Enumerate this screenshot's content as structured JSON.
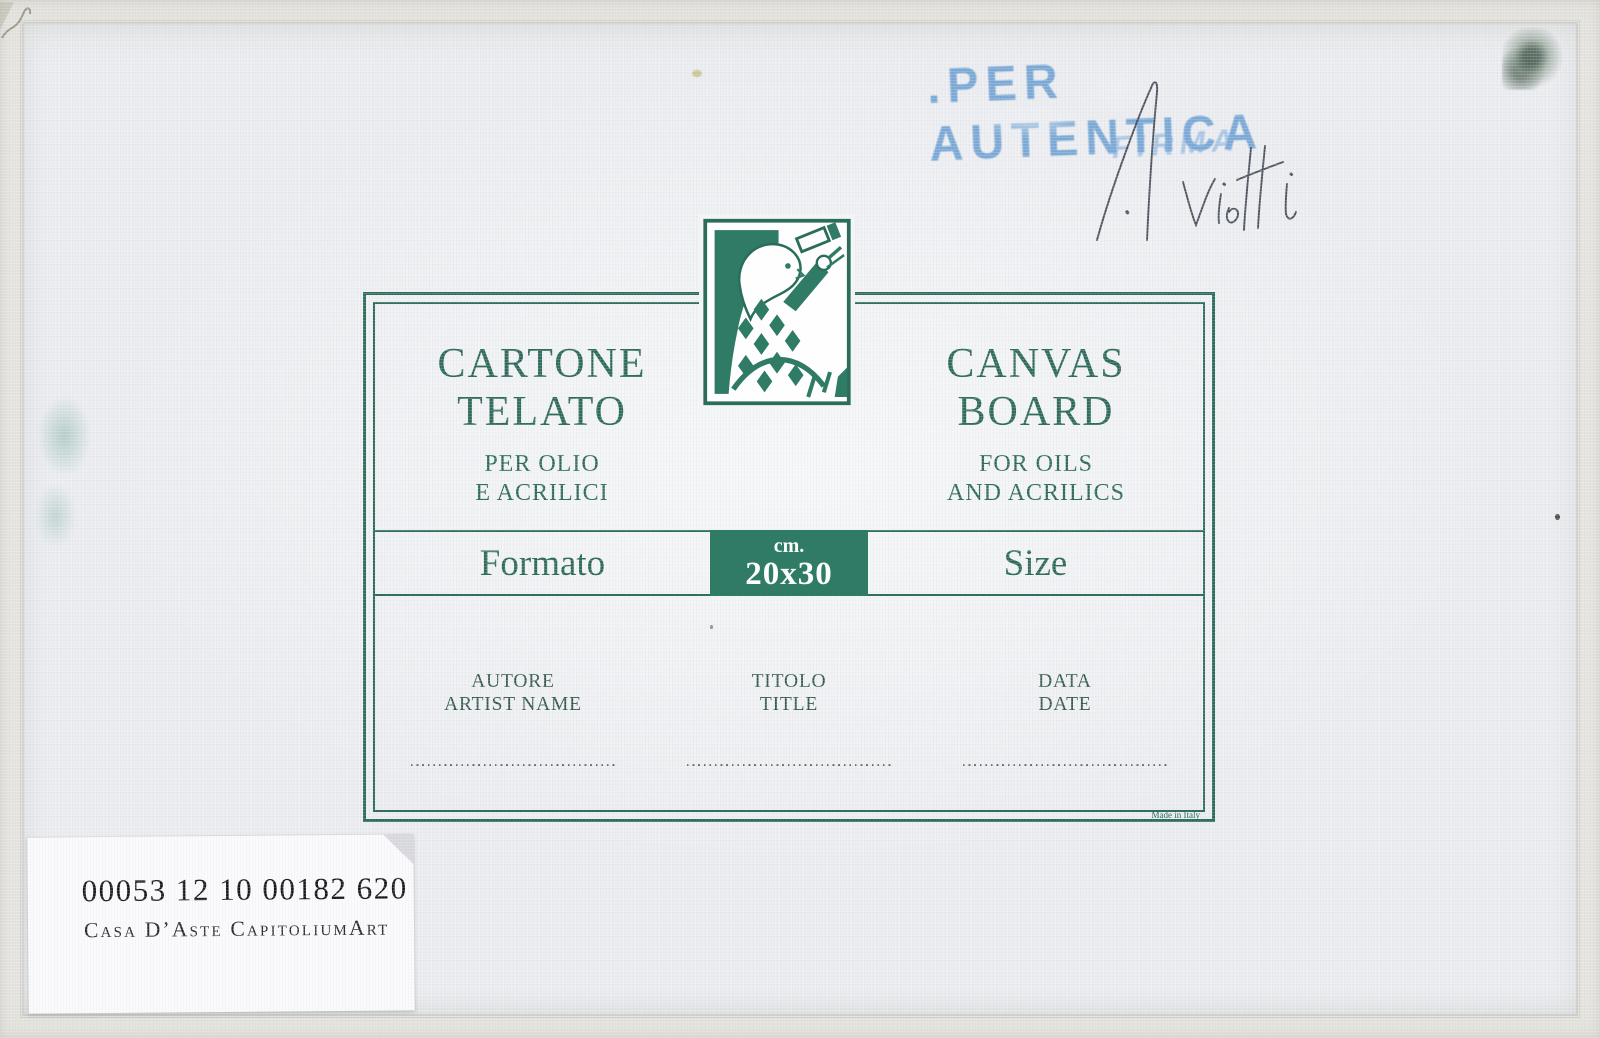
{
  "colors": {
    "label_green": "#2b6c5a",
    "label_fill_green": "#2f7b66",
    "stamp_blue": "#6098d0",
    "board_white": "#edeff3"
  },
  "stamp": {
    "line1": ".PER AUTENTICA",
    "line2": "FIRMA"
  },
  "signature": {
    "text": "N. Vietti"
  },
  "label": {
    "left": {
      "title1": "CARTONE",
      "title2": "TELATO",
      "sub1": "PER OLIO",
      "sub2": "E ACRILICI"
    },
    "right": {
      "title1": "CANVAS",
      "title2": "BOARD",
      "sub1": "FOR OILS",
      "sub2": "AND ACRILICS"
    },
    "size_row": {
      "left_label": "Formato",
      "unit": "cm.",
      "value": "20x30",
      "right_label": "Size"
    },
    "fields": [
      {
        "line1": "AUTORE",
        "line2": "ARTIST NAME"
      },
      {
        "line1": "TITOLO",
        "line2": "TITLE"
      },
      {
        "line1": "DATA",
        "line2": "DATE"
      }
    ],
    "made_in": "Made in Italy"
  },
  "sticker": {
    "line1": "00053 12 10 00182 620",
    "line2": "Casa D’Aste CapitoliumArt"
  }
}
